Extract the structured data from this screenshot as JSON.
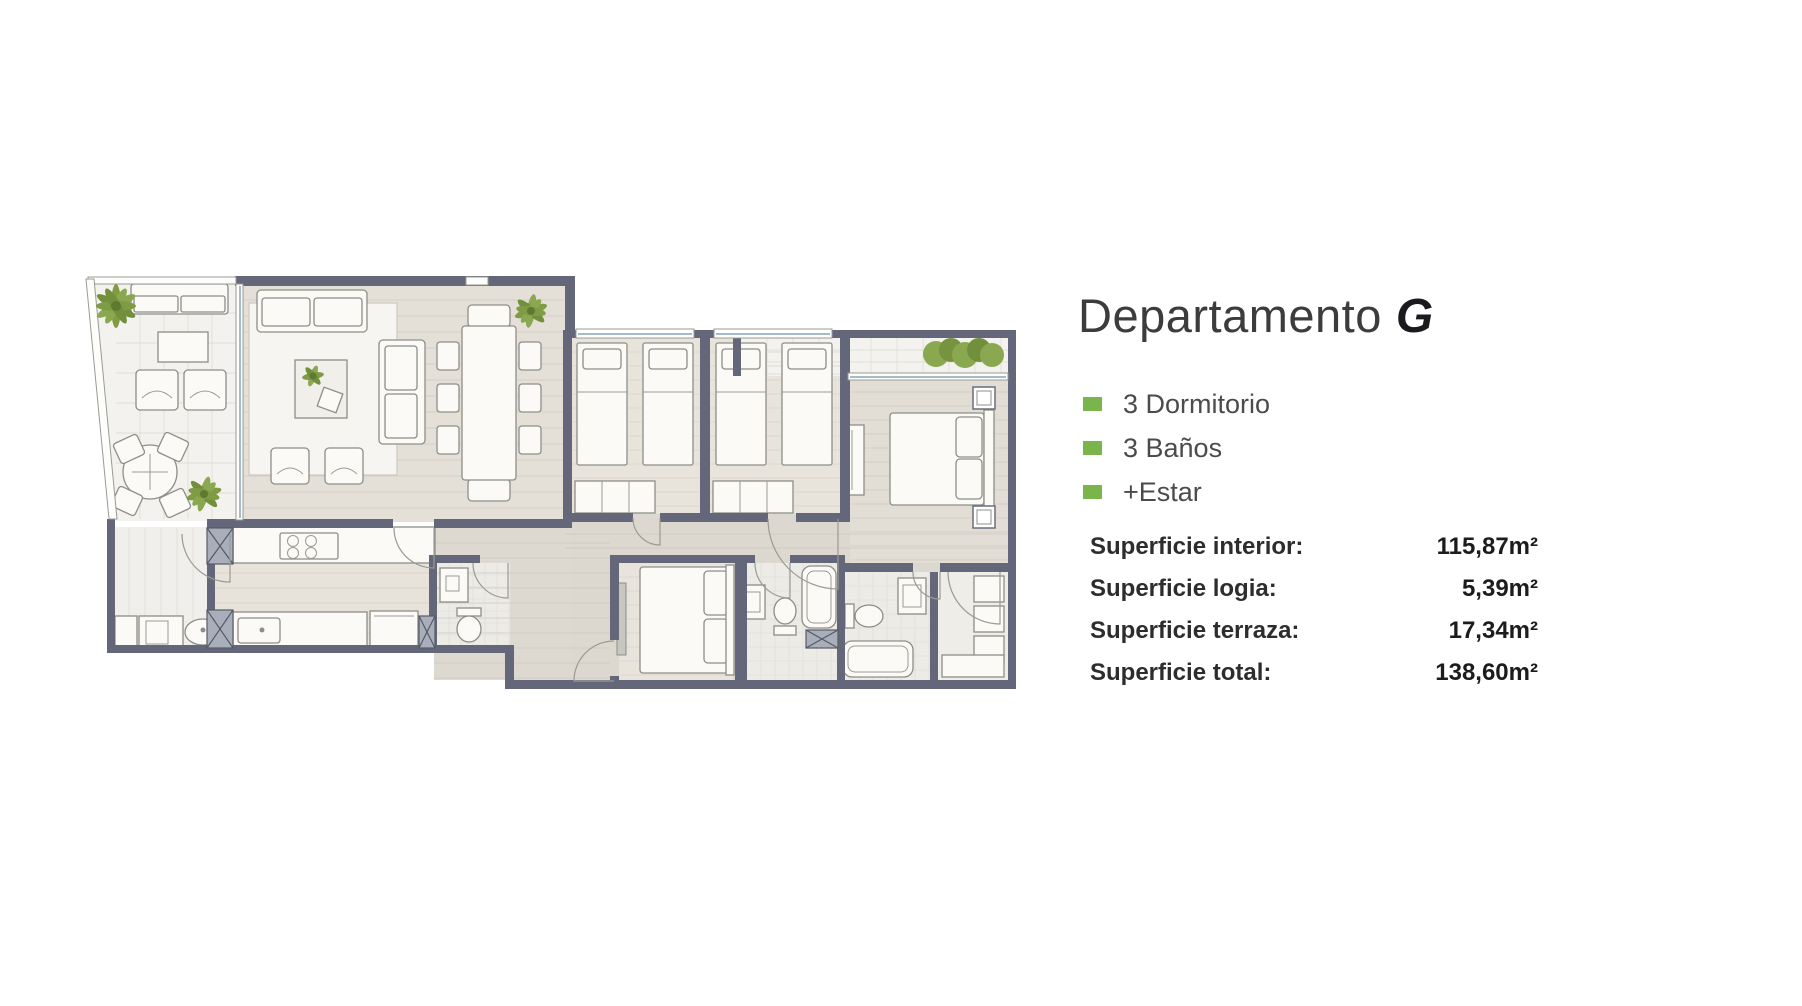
{
  "panel": {
    "title_main": "Departamento",
    "title_unit": "G",
    "features": [
      {
        "label": "3 Dormitorio"
      },
      {
        "label": "3 Baños"
      },
      {
        "label": "+Estar"
      }
    ],
    "surfaces": [
      {
        "label": "Superficie interior:",
        "value": "115,87m²"
      },
      {
        "label": "Superficie logia:",
        "value": "5,39m²"
      },
      {
        "label": "Superficie terraza:",
        "value": "17,34m²"
      },
      {
        "label": "Superficie total:",
        "value": "138,60m²"
      }
    ],
    "accent_color": "#79b54a"
  },
  "floorplan": {
    "colors": {
      "wall": "#646779",
      "floor_main": "#e2ded6",
      "floor_dark": "#dcd8d0",
      "terrace_tile": "#f3f2ee",
      "furniture": "#fbfaf7",
      "outline": "#8d8e88",
      "plant_green": "#7f9c45",
      "window_blue": "#a4bcca"
    }
  }
}
